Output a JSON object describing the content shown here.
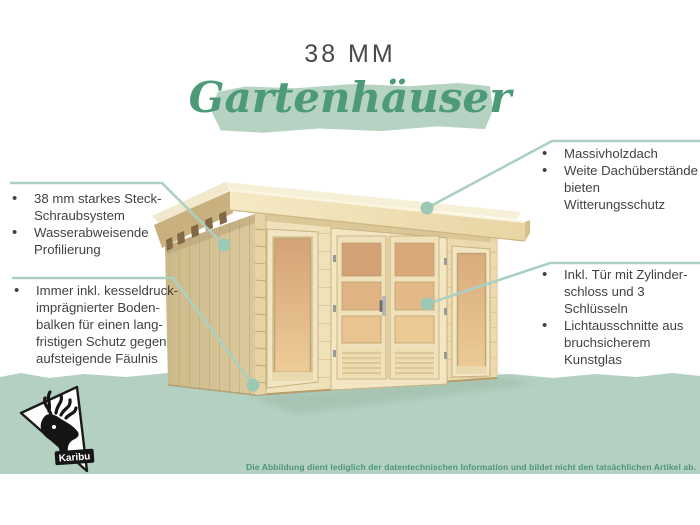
{
  "header": {
    "size_label": "38 MM",
    "category_script": "Gartenhäuser"
  },
  "callouts": {
    "left_top": {
      "target": "roof-overhang-rafters",
      "items": [
        [
          "38 mm starkes Steck-",
          "Schraubsystem"
        ],
        [
          "Wasserabweisende",
          "Profilierung"
        ]
      ]
    },
    "left_bottom": {
      "target": "floor-beams-base",
      "items": [
        [
          "Immer inkl. kesseldruck-",
          "imprägnierter Boden-",
          "balken für einen lang-",
          "fristigen Schutz gegen",
          "aufsteigende Fäulnis"
        ]
      ]
    },
    "right_top": {
      "target": "roof-top",
      "items": [
        [
          "Massivholzdach"
        ],
        [
          "Weite Dachüberstände",
          "bieten Witterungsschutz"
        ]
      ]
    },
    "right_bottom": {
      "target": "door-glass",
      "items": [
        [
          "Inkl. Tür mit Zylinder-",
          "schloss und 3 Schlüsseln"
        ],
        [
          "Lichtausschnitte aus",
          "bruchsicherem Kunstglas"
        ]
      ]
    }
  },
  "footer": {
    "disclaimer": "Die Abbildung dient lediglich der datentechnischen Information und bildet nicht den tatsächlichen Artikel ab."
  },
  "brand": {
    "name": "Karibu"
  },
  "colors": {
    "ground_band": "#b4d0c1",
    "title_highlight": "#b6d2c2",
    "script_green": "#4c9a78",
    "callout_line": "#abd0c1",
    "callout_dot": "#9cc8b6",
    "body_text": "#3f4346",
    "disclaimer_text": "#4e9678",
    "wood_front": "#eedfb4",
    "wood_side": "#d5c294",
    "wood_roof": "#f2e5bd",
    "glass_warm": "#e0b384"
  }
}
